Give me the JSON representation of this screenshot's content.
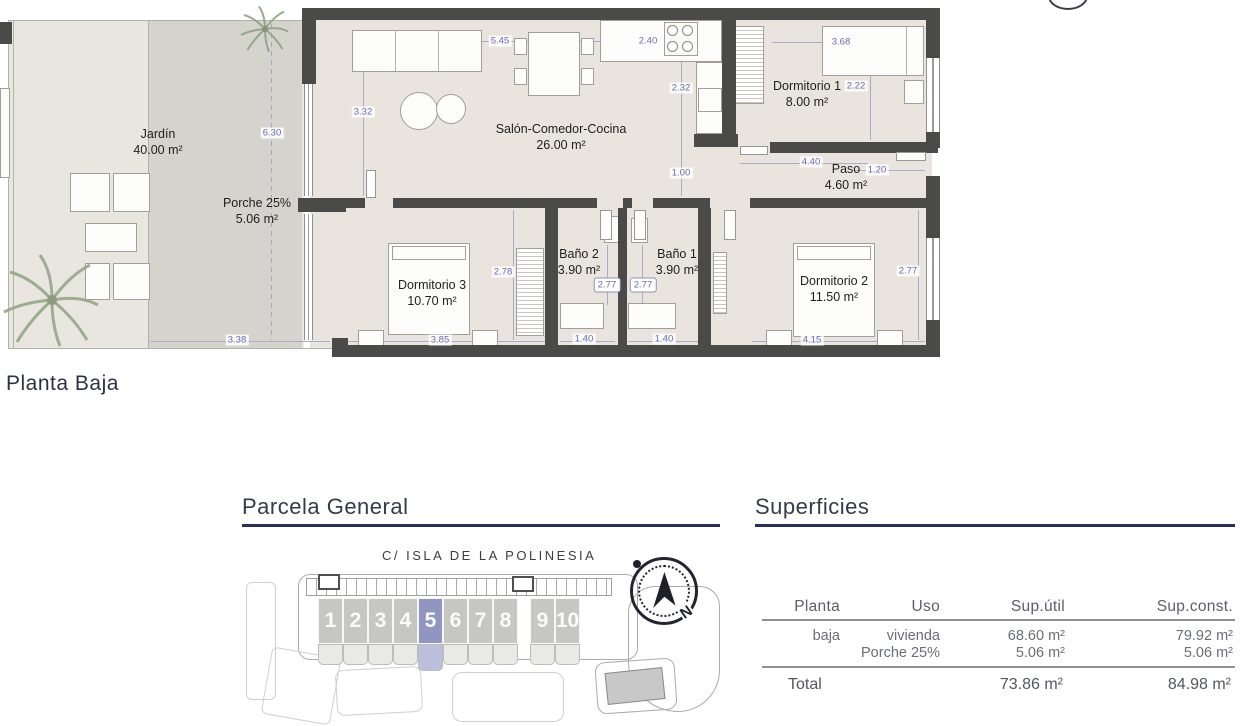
{
  "floorplan": {
    "label": "Planta Baja",
    "rooms": {
      "jardin": {
        "name": "Jardín",
        "area": "40.00 m²"
      },
      "porche": {
        "name": "Porche 25%",
        "area": "5.06 m²"
      },
      "salon": {
        "name": "Salón-Comedor-Cocina",
        "area": "26.00 m²"
      },
      "dorm1": {
        "name": "Dormitorio 1",
        "area": "8.00 m²"
      },
      "paso": {
        "name": "Paso",
        "area": "4.60 m²"
      },
      "bano2": {
        "name": "Baño 2",
        "area": "3.90 m²"
      },
      "bano1": {
        "name": "Baño 1",
        "area": "3.90 m²"
      },
      "dorm3": {
        "name": "Dormitorio 3",
        "area": "10.70 m²"
      },
      "dorm2": {
        "name": "Dormitorio 2",
        "area": "11.50 m²"
      }
    },
    "dims": {
      "jardin_h": "6.30",
      "porche_w": "3.38",
      "salon_w": "5.45",
      "kitchen_w": "2.40",
      "salon_h": "3.32",
      "kitchen_h": "2.32",
      "hall": "1.00",
      "dorm1_w": "3.68",
      "dorm1_h": "2.22",
      "paso_w": "4.40",
      "paso_w2": "1.20",
      "dorm3_h": "2.78",
      "dorm3_w": "3.85",
      "bano2_h": "2.77",
      "bano1_h": "2.77",
      "bano2_w": "1.40",
      "bano1_w": "1.40",
      "dorm2_h": "2.77",
      "dorm2_w": "4.15"
    }
  },
  "parcela": {
    "title": "Parcela General",
    "street": "C/ ISLA DE LA POLINESIA",
    "plots": [
      "1",
      "2",
      "3",
      "4",
      "5",
      "6",
      "7",
      "8",
      "9",
      "10"
    ],
    "highlighted_plot": "5",
    "north": "N"
  },
  "superficies": {
    "title": "Superficies",
    "headers": {
      "planta": "Planta",
      "uso": "Uso",
      "util": "Sup.útil",
      "const": "Sup.const."
    },
    "rows": [
      {
        "planta": "baja",
        "uso": "vivienda",
        "util": "68.60 m²",
        "const": "79.92 m²"
      },
      {
        "planta": "",
        "uso": "Porche 25%",
        "util": "5.06 m²",
        "const": "5.06 m²"
      }
    ],
    "total": {
      "label": "Total",
      "util": "73.86 m²",
      "const": "84.98 m²"
    }
  },
  "colors": {
    "accent": "#9195c2",
    "wall": "#4a4a49",
    "dim_text": "#666bb0",
    "header": "#363a49",
    "underline": "#2b2f58"
  }
}
